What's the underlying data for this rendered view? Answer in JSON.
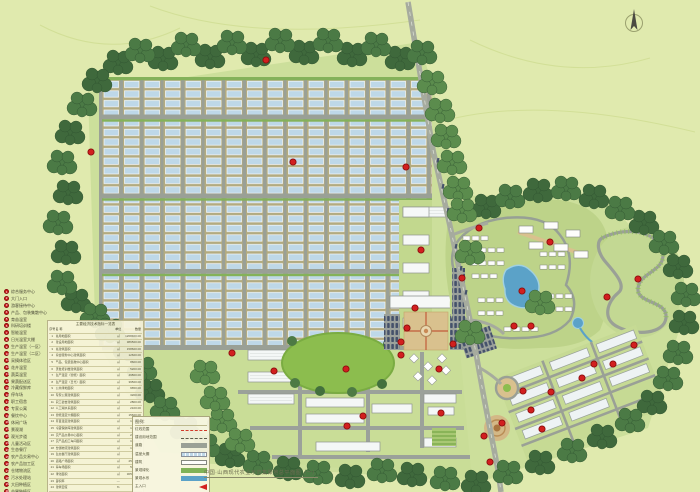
{
  "map": {
    "title": "中国·山西现代农业示范集聚地总平面图（一）",
    "accent_colors": {
      "marker_red": "#d21f1f",
      "greenhouse_blue": "#bed8e8",
      "forest_green": "#3f693c",
      "lawn_green": "#8cbd4e",
      "pond_blue": "#5ba2c8",
      "road_gray": "#9aa096",
      "background": "#e0eaae"
    },
    "markers": [
      [
        91,
        152
      ],
      [
        266,
        60
      ],
      [
        293,
        162
      ],
      [
        406,
        167
      ],
      [
        421,
        250
      ],
      [
        462,
        278
      ],
      [
        415,
        308
      ],
      [
        407,
        328
      ],
      [
        401,
        342
      ],
      [
        401,
        355
      ],
      [
        479,
        228
      ],
      [
        550,
        242
      ],
      [
        522,
        291
      ],
      [
        607,
        297
      ],
      [
        638,
        279
      ],
      [
        634,
        345
      ],
      [
        613,
        364
      ],
      [
        594,
        364
      ],
      [
        582,
        378
      ],
      [
        453,
        344
      ],
      [
        514,
        326
      ],
      [
        531,
        326
      ],
      [
        232,
        353
      ],
      [
        274,
        371
      ],
      [
        346,
        369
      ],
      [
        363,
        416
      ],
      [
        347,
        426
      ],
      [
        439,
        369
      ],
      [
        441,
        413
      ],
      [
        523,
        391
      ],
      [
        531,
        410
      ],
      [
        542,
        429
      ],
      [
        551,
        392
      ],
      [
        484,
        436
      ],
      [
        502,
        423
      ],
      [
        490,
        462
      ]
    ]
  },
  "legend": {
    "items": [
      "综合服务中心",
      "大门入口",
      "游客接待中心",
      "产品、包装集散中心",
      "育苗温室",
      "科研培训楼",
      "智能温室",
      "日光温室大棚",
      "生产温室（一区）",
      "生产温室（二区）",
      "采摘体验区",
      "花卉温室",
      "蔬菜温室",
      "果蔬配送区",
      "冷藏保鲜库",
      "停车场",
      "职工宿舍",
      "专家公寓",
      "餐饮中心",
      "休闲广场",
      "景观湖",
      "观光步道",
      "儿童活动区",
      "生态餐厅",
      "农产品交易中心",
      "农产品加工区",
      "仓储物流区",
      "污水处理站",
      "大田种植区",
      "苗圃种植区"
    ]
  },
  "indicator_table": {
    "title": "主要经济技术指标一览表",
    "columns": [
      "序号",
      "名  称",
      "单位",
      "数量"
    ],
    "rows": [
      [
        "1",
        "总用地面积",
        "㎡",
        "1268400.00"
      ],
      [
        "2",
        "建设用地面积",
        "㎡",
        "386500.00"
      ],
      [
        "3",
        "总建筑面积",
        "㎡",
        "158600.00"
      ],
      [
        "4",
        "综合服务中心建筑面积",
        "㎡",
        "12600.00"
      ],
      [
        "5",
        "产品、包装集散中心面积",
        "㎡",
        "8600.00"
      ],
      [
        "6",
        "研发培训楼建筑面积",
        "㎡",
        "5200.00"
      ],
      [
        "7",
        "生产温室（智能）面积",
        "㎡",
        "49800.00"
      ],
      [
        "8",
        "生产温室（日光）面积",
        "㎡",
        "39500.00"
      ],
      [
        "9",
        "公共绿地面积",
        "㎡",
        "9650.00"
      ],
      [
        "10",
        "专家公寓建筑面积",
        "㎡",
        "3200.00"
      ],
      [
        "11",
        "职工宿舍建筑面积",
        "㎡",
        "2800.00"
      ],
      [
        "12",
        "人工湖水系面积",
        "㎡",
        "2100.00"
      ],
      [
        "13",
        "智能温室大棚面积",
        "㎡",
        "15600.00"
      ],
      [
        "14",
        "育苗温室建筑面积",
        "㎡",
        "1350.00"
      ],
      [
        "15",
        "冷藏保鲜库建筑面积",
        "㎡",
        "1200.00"
      ],
      [
        "16",
        "农产品交易中心面积",
        "㎡",
        "2260.00"
      ],
      [
        "17",
        "农产品加工车间面积",
        "㎡",
        "1980.00"
      ],
      [
        "18",
        "仓储物流建筑面积",
        "㎡",
        "1750.00"
      ],
      [
        "19",
        "生态餐厅建筑面积",
        "㎡",
        "980.00"
      ],
      [
        "20",
        "道路广场面积",
        "㎡",
        "25600.00"
      ],
      [
        "21",
        "停车场面积",
        "㎡",
        "5600.00"
      ],
      [
        "22",
        "绿化面积",
        "㎡",
        "305000.00"
      ],
      [
        "23",
        "容积率",
        "—",
        "0.13"
      ],
      [
        "24",
        "建筑密度",
        "%",
        "12.50"
      ],
      [
        "25",
        "绿地率",
        "%",
        "38.60"
      ],
      [
        "26",
        "停车位",
        "辆",
        "260"
      ]
    ]
  },
  "mini_legend": {
    "title": "图例:",
    "rows": [
      {
        "label": "红线范围",
        "swatch": "red-dash"
      },
      {
        "label": "建设用地范围",
        "swatch": "dark-dash"
      },
      {
        "label": "道路",
        "swatch": "road"
      },
      {
        "label": "温室大棚",
        "swatch": "greenhouse"
      },
      {
        "label": "建筑",
        "swatch": "building"
      },
      {
        "label": "景观绿化",
        "swatch": "green"
      },
      {
        "label": "景观水系",
        "swatch": "water"
      },
      {
        "label": "主入口",
        "swatch": "arrow"
      },
      {
        "label": "水系",
        "swatch": "stream"
      }
    ]
  }
}
